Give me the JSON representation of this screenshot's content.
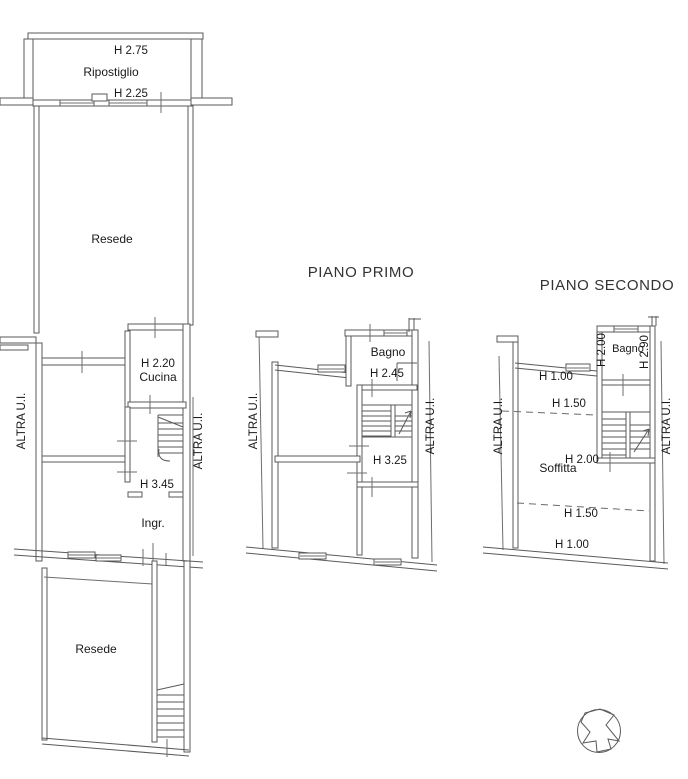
{
  "meta": {
    "background": "#ffffff",
    "line_color": "#5a5a5a",
    "text_color": "#191919"
  },
  "ground_floor": {
    "h_ripostiglio": "H 2.75",
    "ripostiglio": "Ripostiglio",
    "h_wall": "H 2.25",
    "resede_top": "Resede",
    "h_cucina": "H 2.20",
    "cucina": "Cucina",
    "h_ingresso": "H 3.45",
    "ingresso": "Ingr.",
    "resede_bottom": "Resede",
    "adjacent_left": "ALTRA U.I.",
    "adjacent_right": "ALTRA U.I."
  },
  "first_floor": {
    "title": "PIANO PRIMO",
    "bagno": "Bagno",
    "h_bagno": "H 2.45",
    "h_room": "H 3.25",
    "adjacent_left": "ALTRA U.I.",
    "adjacent_right": "ALTRA U.I."
  },
  "second_floor": {
    "title": "PIANO SECONDO",
    "bagno": "Bagno",
    "h_bagno_left": "H 2.00",
    "h_bagno_right": "H 2.90",
    "h_eaves_top": "H 1.00",
    "h_mid_top": "H 1.50",
    "h_ridge": "H 2.00",
    "soffitta": "Soffitta",
    "h_mid_bottom": "H 1.50",
    "h_eaves_bottom": "H 1.00",
    "adjacent_left": "ALTRA U.I.",
    "adjacent_right": "ALTRA U.I."
  },
  "compass": {
    "type": "north-arrow"
  }
}
